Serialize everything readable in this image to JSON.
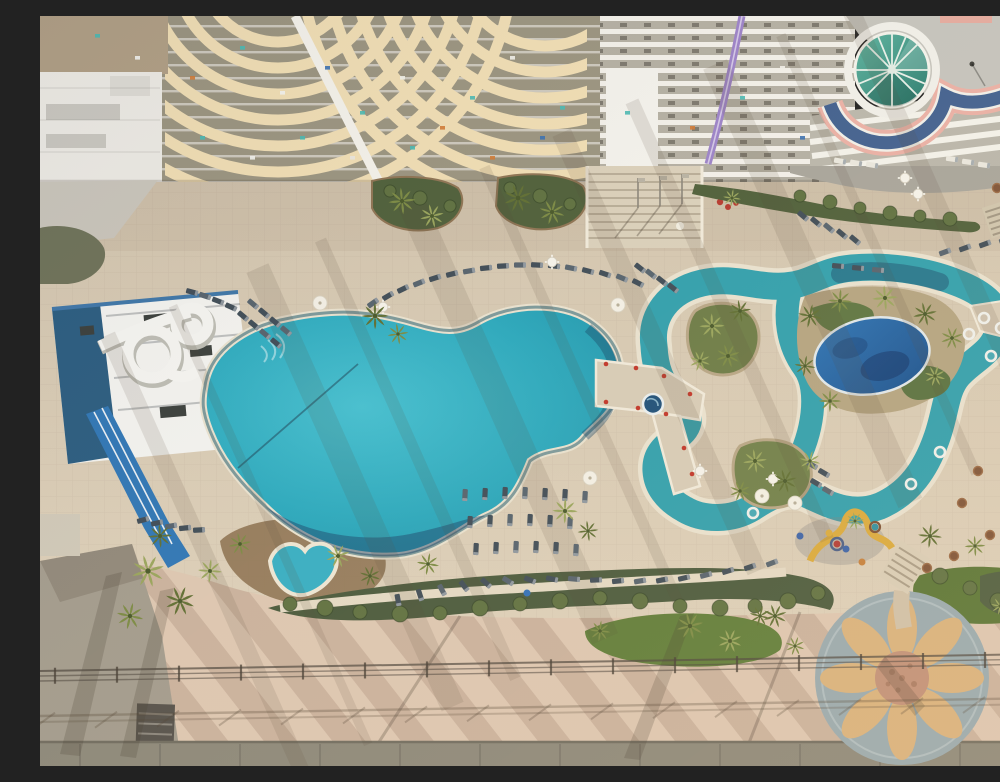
{
  "scene": {
    "type": "aerial-photograph",
    "subject": "beachfront-resort-pool-deck",
    "features": [
      "high-rise-towers-with-curved-balconies",
      "teal-glass-dome",
      "purple-water-slide",
      "white-loop-water-slide-tower",
      "blue-flume-slide",
      "freeform-main-pool",
      "heart-shaped-kiddie-pool",
      "lazy-river-with-palm-islands",
      "deep-blue-lagoon-pool",
      "footbridge-with-spa",
      "lounge-chair-rows",
      "sun-mosaic-medallion",
      "boardwalk-with-railing",
      "palm-trees",
      "hedges-and-lawns"
    ]
  },
  "colors": {
    "deck": "#d7cbb6",
    "terrace": "#d0c4ae",
    "grayTerrace": "#a7a49b",
    "boardwalk": "#dcc6b1",
    "bottomStrip": "#8b8779",
    "darkPave": "#a29b8d",
    "buildingCream": "#efddb4",
    "buildingGray": "#9a9480",
    "wingGray": "#b3afa3",
    "white": "#f2f1ec",
    "poolMain": "#2cabc0",
    "poolDeep": "#1f97ae",
    "lagoonNavy": "#235d85",
    "river": "#2f9fad",
    "bluePool": "#1f62a8",
    "kidPool": "#36aec3",
    "coping": "#e8e1cf",
    "hedge": "#49593c",
    "grass": "#5e7c38",
    "mulch": "#8d7353",
    "palm1": "#7b8a44",
    "palm2": "#98a45c",
    "palm3": "#5f6e33",
    "lounger": "#3f4c57",
    "loungerLight": "#55626d",
    "mosaicBg": "#97a9af",
    "mosaicPetal": "#d8b17c",
    "mosaicCenter": "#c08f77",
    "domeTeal": "#3fa08d",
    "domePink": "#e9b0a5",
    "domeBlue": "#41608f",
    "purpleSlide": "#9b82c8",
    "slideBlue": "#2f76b5",
    "towerNavy": "#2a5c80",
    "fence": "#4b453c"
  },
  "objects": {
    "palms": [
      [
        362,
        185,
        0.9
      ],
      [
        392,
        200,
        0.8
      ],
      [
        478,
        182,
        0.95
      ],
      [
        512,
        196,
        0.85
      ],
      [
        692,
        182,
        0.6
      ],
      [
        335,
        300,
        0.9
      ],
      [
        358,
        318,
        0.7
      ],
      [
        108,
        555,
        1.1
      ],
      [
        140,
        585,
        1.0
      ],
      [
        90,
        600,
        0.9
      ],
      [
        170,
        555,
        0.8
      ],
      [
        120,
        520,
        0.8
      ],
      [
        200,
        528,
        0.75
      ],
      [
        298,
        540,
        0.8
      ],
      [
        330,
        560,
        0.7
      ],
      [
        388,
        548,
        0.75
      ],
      [
        525,
        495,
        0.85
      ],
      [
        548,
        515,
        0.7
      ],
      [
        650,
        610,
        0.9
      ],
      [
        690,
        625,
        0.8
      ],
      [
        720,
        600,
        0.7
      ],
      [
        560,
        615,
        0.7
      ],
      [
        672,
        310,
        0.85
      ],
      [
        700,
        295,
        0.75
      ],
      [
        688,
        340,
        0.8
      ],
      [
        660,
        345,
        0.7
      ],
      [
        770,
        300,
        0.8
      ],
      [
        800,
        285,
        0.8
      ],
      [
        845,
        282,
        0.85
      ],
      [
        885,
        298,
        0.8
      ],
      [
        912,
        322,
        0.75
      ],
      [
        895,
        360,
        0.7
      ],
      [
        765,
        350,
        0.7
      ],
      [
        790,
        385,
        0.75
      ],
      [
        715,
        445,
        0.8
      ],
      [
        745,
        465,
        0.8
      ],
      [
        700,
        475,
        0.7
      ],
      [
        770,
        445,
        0.7
      ],
      [
        890,
        520,
        0.8
      ],
      [
        935,
        530,
        0.7
      ],
      [
        815,
        505,
        0.6
      ],
      [
        735,
        600,
        0.8
      ],
      [
        755,
        630,
        0.65
      ],
      [
        960,
        590,
        0.6
      ],
      [
        985,
        620,
        0.55
      ]
    ],
    "loungers": [
      [
        333,
        287,
        -35
      ],
      [
        348,
        280,
        -30
      ],
      [
        363,
        273,
        -26
      ],
      [
        379,
        267,
        -22
      ],
      [
        395,
        262,
        -18
      ],
      [
        412,
        258,
        -14
      ],
      [
        429,
        255,
        -10
      ],
      [
        446,
        252,
        -6
      ],
      [
        463,
        250,
        -3
      ],
      [
        480,
        249,
        0
      ],
      [
        497,
        249,
        3
      ],
      [
        514,
        250,
        7
      ],
      [
        531,
        252,
        11
      ],
      [
        548,
        255,
        15
      ],
      [
        565,
        258,
        19
      ],
      [
        582,
        262,
        23
      ],
      [
        598,
        267,
        27
      ],
      [
        600,
        252,
        38
      ],
      [
        611,
        258,
        38
      ],
      [
        622,
        265,
        38
      ],
      [
        633,
        272,
        38
      ],
      [
        213,
        288,
        40
      ],
      [
        224,
        297,
        40
      ],
      [
        235,
        306,
        40
      ],
      [
        246,
        315,
        40
      ],
      [
        203,
        300,
        40
      ],
      [
        214,
        309,
        40
      ],
      [
        225,
        318,
        40
      ],
      [
        236,
        327,
        40
      ],
      [
        152,
        276,
        15
      ],
      [
        165,
        280,
        18
      ],
      [
        178,
        285,
        21
      ],
      [
        191,
        291,
        24
      ],
      [
        425,
        479,
        93
      ],
      [
        445,
        478,
        93
      ],
      [
        465,
        477,
        93
      ],
      [
        485,
        477,
        93
      ],
      [
        505,
        478,
        93
      ],
      [
        525,
        479,
        93
      ],
      [
        545,
        481,
        93
      ],
      [
        430,
        506,
        93
      ],
      [
        450,
        505,
        93
      ],
      [
        470,
        504,
        93
      ],
      [
        490,
        504,
        93
      ],
      [
        510,
        505,
        93
      ],
      [
        530,
        507,
        93
      ],
      [
        436,
        533,
        93
      ],
      [
        456,
        532,
        93
      ],
      [
        476,
        531,
        93
      ],
      [
        496,
        531,
        93
      ],
      [
        516,
        532,
        93
      ],
      [
        536,
        534,
        93
      ],
      [
        358,
        584,
        80
      ],
      [
        380,
        579,
        72
      ],
      [
        402,
        574,
        62
      ],
      [
        424,
        570,
        52
      ],
      [
        446,
        567,
        42
      ],
      [
        468,
        565,
        32
      ],
      [
        490,
        564,
        22
      ],
      [
        512,
        563,
        12
      ],
      [
        534,
        563,
        5
      ],
      [
        556,
        564,
        -2
      ],
      [
        578,
        565,
        -6
      ],
      [
        600,
        565,
        -9
      ],
      [
        622,
        564,
        -11
      ],
      [
        644,
        562,
        -13
      ],
      [
        666,
        559,
        -15
      ],
      [
        688,
        555,
        -17
      ],
      [
        710,
        551,
        -19
      ],
      [
        732,
        547,
        -21
      ],
      [
        103,
        504,
        -15
      ],
      [
        117,
        507,
        -12
      ],
      [
        131,
        510,
        -9
      ],
      [
        145,
        512,
        -6
      ],
      [
        159,
        514,
        -3
      ],
      [
        772,
        449,
        30
      ],
      [
        784,
        457,
        30
      ],
      [
        776,
        467,
        30
      ],
      [
        788,
        475,
        30
      ],
      [
        763,
        200,
        40
      ],
      [
        776,
        206,
        40
      ],
      [
        789,
        212,
        40
      ],
      [
        802,
        218,
        40
      ],
      [
        815,
        224,
        40
      ],
      [
        905,
        236,
        -20
      ],
      [
        925,
        232,
        -20
      ],
      [
        945,
        228,
        -20
      ],
      [
        965,
        224,
        -20
      ],
      [
        798,
        250,
        5
      ],
      [
        818,
        252,
        5
      ],
      [
        838,
        254,
        5
      ]
    ],
    "white_loungers": [
      [
        800,
        145,
        10
      ],
      [
        816,
        147,
        10
      ],
      [
        832,
        149,
        10
      ],
      [
        912,
        143,
        8
      ],
      [
        928,
        146,
        8
      ],
      [
        944,
        149,
        8
      ]
    ],
    "tubes": [
      [
        944,
        302
      ],
      [
        961,
        312
      ],
      [
        973,
        327
      ],
      [
        951,
        340
      ],
      [
        929,
        318
      ],
      [
        900,
        436
      ],
      [
        871,
        468
      ],
      [
        713,
        497
      ]
    ],
    "white_tables": [
      [
        343,
        291
      ],
      [
        512,
        246
      ],
      [
        660,
        455
      ],
      [
        733,
        463
      ],
      [
        865,
        162
      ],
      [
        878,
        178
      ]
    ],
    "brown_tables": [
      [
        938,
        455
      ],
      [
        922,
        487
      ],
      [
        950,
        519
      ],
      [
        914,
        540
      ],
      [
        887,
        552
      ],
      [
        957,
        172
      ]
    ],
    "umbrellas": [
      [
        280,
        287
      ],
      [
        578,
        289
      ],
      [
        550,
        462
      ],
      [
        722,
        480
      ],
      [
        755,
        487
      ]
    ],
    "bushes": [
      [
        250,
        588,
        7
      ],
      [
        285,
        592,
        8
      ],
      [
        320,
        596,
        7
      ],
      [
        360,
        598,
        8
      ],
      [
        400,
        597,
        7
      ],
      [
        440,
        592,
        8
      ],
      [
        480,
        588,
        7
      ],
      [
        520,
        585,
        8
      ],
      [
        560,
        582,
        7
      ],
      [
        600,
        585,
        8
      ],
      [
        640,
        590,
        7
      ],
      [
        680,
        592,
        8
      ],
      [
        715,
        590,
        7
      ],
      [
        748,
        585,
        8
      ],
      [
        778,
        577,
        7
      ],
      [
        900,
        560,
        8
      ],
      [
        930,
        572,
        7
      ],
      [
        958,
        585,
        8
      ],
      [
        760,
        180,
        6
      ],
      [
        790,
        186,
        7
      ],
      [
        820,
        192,
        6
      ],
      [
        850,
        197,
        7
      ],
      [
        880,
        200,
        6
      ],
      [
        910,
        203,
        7
      ],
      [
        350,
        175,
        6
      ],
      [
        380,
        182,
        7
      ],
      [
        410,
        190,
        6
      ],
      [
        470,
        172,
        6
      ],
      [
        500,
        180,
        7
      ],
      [
        530,
        188,
        6
      ]
    ],
    "play_dots": [
      [
        797,
        528,
        "#b23a35"
      ],
      [
        806,
        533,
        "#3a62a8"
      ],
      [
        835,
        511,
        "#2f8fa0"
      ],
      [
        822,
        546,
        "#c47f3b"
      ],
      [
        789,
        517,
        "#d9a93c"
      ],
      [
        760,
        520,
        "#3a62a8"
      ],
      [
        487,
        577,
        "#2f6fb8"
      ]
    ],
    "balcony_specks": [
      [
        55,
        18,
        "#49b8b2"
      ],
      [
        95,
        40,
        "#f2f2ee"
      ],
      [
        150,
        60,
        "#d07a35"
      ],
      [
        200,
        30,
        "#49b8b2"
      ],
      [
        240,
        75,
        "#f2f2ee"
      ],
      [
        285,
        50,
        "#3a6fb0"
      ],
      [
        320,
        95,
        "#49b8b2"
      ],
      [
        360,
        60,
        "#f0efe8"
      ],
      [
        400,
        110,
        "#d07a35"
      ],
      [
        430,
        80,
        "#49b8b2"
      ],
      [
        470,
        40,
        "#f1efe9"
      ],
      [
        500,
        120,
        "#3a6fb0"
      ],
      [
        585,
        95,
        "#49b8b2"
      ],
      [
        610,
        60,
        "#f2f0ea"
      ],
      [
        650,
        110,
        "#d07a35"
      ],
      [
        700,
        80,
        "#49b8b2"
      ],
      [
        740,
        50,
        "#f1efe9"
      ],
      [
        760,
        120,
        "#3a6fb0"
      ],
      [
        160,
        120,
        "#49b8b2"
      ],
      [
        210,
        140,
        "#f2f2ee"
      ],
      [
        260,
        120,
        "#49b8b2"
      ],
      [
        310,
        140,
        "#e8e6df"
      ],
      [
        370,
        130,
        "#49b8b2"
      ],
      [
        450,
        140,
        "#d07a35"
      ],
      [
        520,
        90,
        "#49b8b2"
      ],
      [
        560,
        130,
        "#f1efe9"
      ]
    ],
    "shadow_streaks": [
      [
        130,
        16
      ],
      [
        205,
        9
      ],
      [
        290,
        24
      ],
      [
        365,
        12
      ],
      [
        455,
        28
      ],
      [
        545,
        11
      ],
      [
        625,
        20
      ],
      [
        705,
        14
      ],
      [
        790,
        26
      ],
      [
        870,
        10
      ],
      [
        940,
        18
      ]
    ]
  }
}
